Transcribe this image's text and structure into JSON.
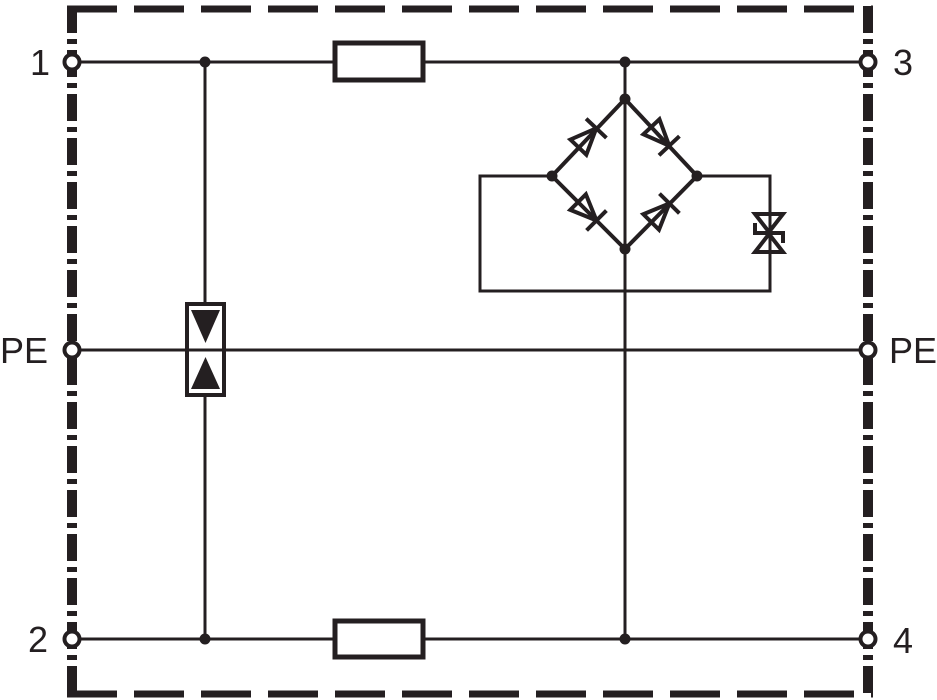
{
  "canvas": {
    "width": 937,
    "height": 700,
    "background_color": "#ffffff",
    "ink_color": "#241f21"
  },
  "diagram": {
    "kind": "surge-protective-device-circuit",
    "boundary_style": "dashed-outline",
    "labels": {
      "terminal_1": "1",
      "terminal_2": "2",
      "terminal_3": "3",
      "terminal_4": "4",
      "pe_left": "PE",
      "pe_right": "PE"
    },
    "components": [
      {
        "name": "series-impedance-top-icon",
        "symbol": "empty-rectangle",
        "between": [
          "1",
          "3"
        ]
      },
      {
        "name": "series-impedance-bottom-icon",
        "symbol": "empty-rectangle",
        "between": [
          "2",
          "4"
        ]
      },
      {
        "name": "gas-discharge-tube-icon",
        "symbol": "box-with-two-opposed-filled-triangles",
        "connects": [
          "line-1-3",
          "PE",
          "line-2-4"
        ]
      },
      {
        "name": "diode-bridge-icon",
        "symbol": "diamond-of-four-diodes",
        "connects": [
          "line-1-3",
          "line-2-4"
        ]
      },
      {
        "name": "suppressor-diode-icon",
        "symbol": "bidirectional-zener-hourglass",
        "connects": [
          "bridge-dc-nodes"
        ]
      }
    ]
  }
}
